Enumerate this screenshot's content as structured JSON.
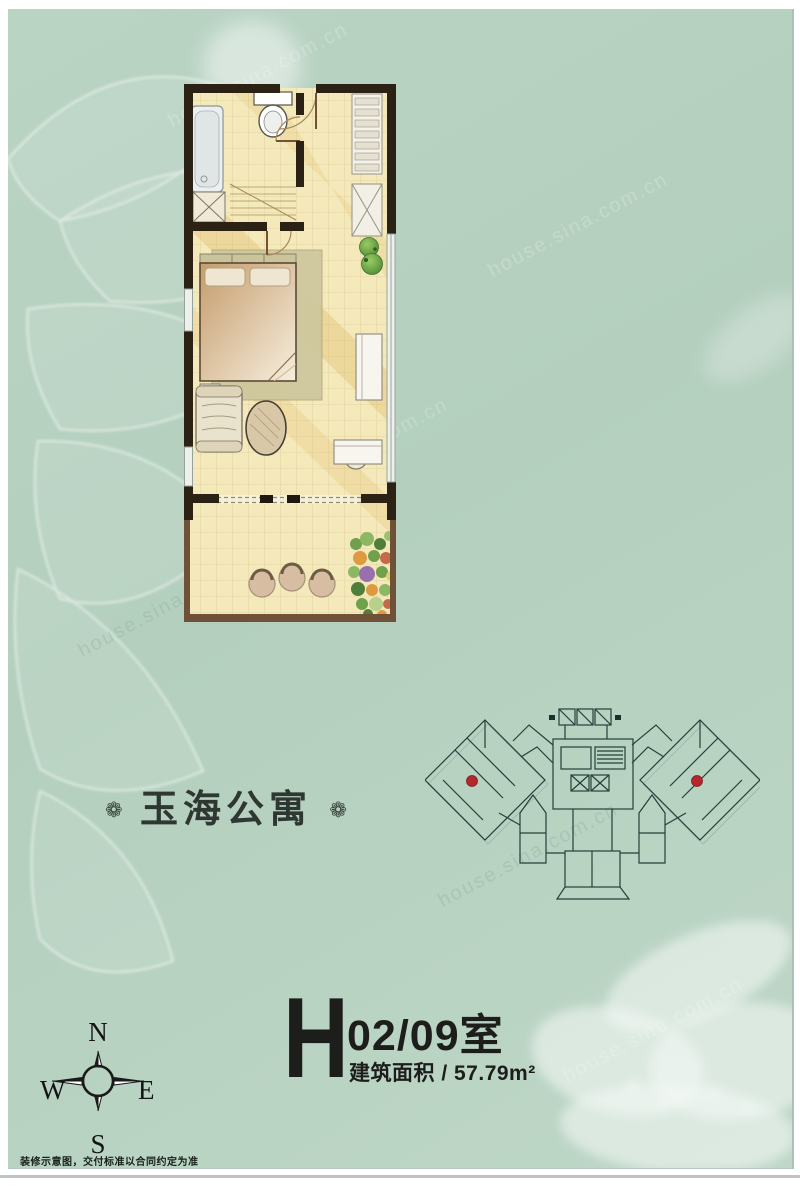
{
  "title_plate": {
    "ornament_left": "❁",
    "title": "玉海公寓",
    "ornament_right": "❁"
  },
  "unit_info": {
    "letter": "H",
    "number": "02/09室",
    "area": "建筑面积 / 57.79m²"
  },
  "compass": {
    "north": "N",
    "east": "E",
    "south": "S",
    "west": "W"
  },
  "footer": {
    "disclaimer": "装修示意图，交付标准以合同约定为准"
  },
  "watermark": {
    "text": "house.sina.com.cn"
  },
  "palette": {
    "background_green": "#b7d1c1",
    "floor_yellow": "#f4e9bb",
    "wall_dark": "#2b2114",
    "balcony_wall_brown": "#6e5136",
    "marker_red": "#b3282d",
    "text_dark": "#1d1d1b"
  },
  "floor_plan": {
    "rooms": [
      "bathroom",
      "entry-hall",
      "kitchenette",
      "living-bedroom",
      "balcony"
    ],
    "furniture": [
      "bathtub",
      "toilet",
      "shower-box",
      "staircase",
      "kitchen-counter",
      "wardrobe",
      "potted-plant",
      "double-bed",
      "area-rug",
      "nightstand",
      "sofa",
      "oval-lounge",
      "dresser",
      "desk-with-chair",
      "balcony-stools",
      "flower-bed"
    ]
  },
  "site_plan": {
    "unit_markers": 2,
    "marker_color": "#b3282d"
  }
}
